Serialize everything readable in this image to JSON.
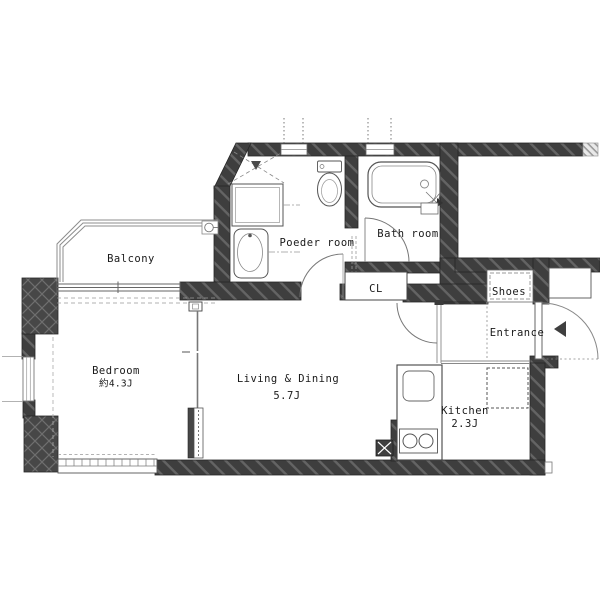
{
  "plan": {
    "type": "apartment-floor-plan",
    "rooms": [
      {
        "id": "balcony",
        "label": "Balcony"
      },
      {
        "id": "bedroom",
        "label": "Bedroom",
        "area": "約4.3J"
      },
      {
        "id": "living_dining",
        "label": "Living & Dining",
        "area": "5.7J"
      },
      {
        "id": "powder_room",
        "label": "Poeder room"
      },
      {
        "id": "bath_room",
        "label": "Bath room"
      },
      {
        "id": "closet",
        "label": "CL"
      },
      {
        "id": "shoes",
        "label": "Shoes"
      },
      {
        "id": "entrance",
        "label": "Entrance"
      },
      {
        "id": "kitchen",
        "label": "Kitchen",
        "area": "2.3J"
      }
    ],
    "fixtures": [
      "bathtub",
      "toilet",
      "washbasin",
      "washing-machine-space",
      "washing-machine-pan",
      "kitchen-counter",
      "kitchen-sink",
      "gas-stove",
      "refrigerator-space",
      "pipe-shaft",
      "shoe-cabinet",
      "meter-box",
      "entrance-door",
      "bath-door",
      "powder-room-door",
      "living-door",
      "sliding-partition",
      "balcony-sliding-window",
      "bedroom-side-window",
      "bedroom-low-window",
      "balcony-drain"
    ],
    "colors": {
      "wall": "#3e3e3e",
      "wall_stripe": "#646464",
      "pillar": "#474747",
      "line": "#555555",
      "light_line": "#999999",
      "text": "#1a1a1a",
      "background": "#ffffff"
    }
  }
}
